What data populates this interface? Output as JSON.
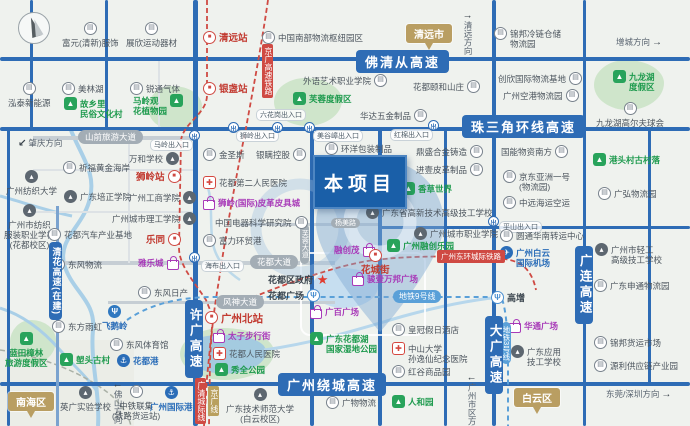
{
  "project": {
    "label": "本项目"
  },
  "colors": {
    "highway_blue": "#2e6cb5",
    "rail_red": "#cf4a43",
    "metro_blue": "#5aa0d8",
    "green_poi": "#1d9a4d",
    "purple_poi": "#a83ab8",
    "blue_poi": "#2a6db8",
    "station_red": "#c23a30",
    "city_tan": "#b99e62",
    "project_blue": "#1a5fa8",
    "water": "#a9cfe7"
  },
  "icon_glyphs": {
    "factory": "▤",
    "school": "▴",
    "tree": "▲",
    "hosp": "✚",
    "star": "★",
    "rail": "■",
    "metro": "Ψ",
    "metro2": "Ψ",
    "anchor": "⚓",
    "plane": "✈",
    "bag": "",
    "exit": "出"
  },
  "map": {
    "pois": [
      {
        "x": 62,
        "y": 22,
        "ic": "factory",
        "side": "t",
        "t": "富元(清新)服饰"
      },
      {
        "x": 126,
        "y": 22,
        "ic": "factory",
        "side": "t",
        "t": "展欣运动器材"
      },
      {
        "x": 203,
        "y": 31,
        "ic": "rail",
        "t": "清远站",
        "c": "red"
      },
      {
        "x": 262,
        "y": 31,
        "ic": "factory",
        "t": "中国南部物流枢纽园区"
      },
      {
        "x": 494,
        "y": 27,
        "ic": "factory",
        "t": "锦邦冷链仓储\n物流园"
      },
      {
        "x": 8,
        "y": 82,
        "ic": "factory",
        "side": "t",
        "t": "泓泰新能源"
      },
      {
        "x": 62,
        "y": 82,
        "ic": "factory",
        "t": "美林湖"
      },
      {
        "x": 130,
        "y": 82,
        "ic": "factory",
        "t": "锐通气体"
      },
      {
        "x": 64,
        "y": 97,
        "ic": "tree",
        "t": "故乡里\n民俗文化村",
        "c": "green"
      },
      {
        "x": 133,
        "y": 94,
        "ic": "tree",
        "side": "r",
        "t": "马岭观\n花植物园",
        "c": "green"
      },
      {
        "x": 203,
        "y": 82,
        "ic": "rail",
        "t": "银盏站",
        "c": "red"
      },
      {
        "x": 303,
        "y": 74,
        "ic": "factory",
        "side": "r",
        "t": "外语艺术职业学院"
      },
      {
        "x": 293,
        "y": 92,
        "ic": "tree",
        "t": "芙蓉度假区",
        "c": "green"
      },
      {
        "x": 413,
        "y": 80,
        "ic": "factory",
        "side": "r",
        "t": "花都颐和山庄"
      },
      {
        "x": 498,
        "y": 72,
        "ic": "factory",
        "side": "r",
        "t": "创欣国际物流基地"
      },
      {
        "x": 503,
        "y": 89,
        "ic": "factory",
        "side": "r",
        "t": "广州空港物流园"
      },
      {
        "x": 613,
        "y": 70,
        "ic": "tree",
        "t": "九龙湖\n度假区",
        "c": "green"
      },
      {
        "x": 596,
        "y": 102,
        "ic": "factory",
        "side": "t",
        "t": "九龙湖高尔夫球会"
      },
      {
        "x": 360,
        "y": 109,
        "ic": "factory",
        "side": "r",
        "t": "华达五金制品"
      },
      {
        "x": 6,
        "y": 170,
        "ic": "school",
        "side": "t",
        "t": "广州纺织大学"
      },
      {
        "x": 4,
        "y": 204,
        "ic": "school",
        "side": "t",
        "t": "广州市纺织\n服装职业学校\n(花都校区)"
      },
      {
        "x": 63,
        "y": 161,
        "ic": "factory",
        "t": "祈福黄金海岸"
      },
      {
        "x": 129,
        "y": 152,
        "ic": "school",
        "side": "r",
        "t": "万和学校"
      },
      {
        "x": 136,
        "y": 170,
        "ic": "rail",
        "side": "r",
        "t": "狮岭站",
        "c": "red"
      },
      {
        "x": 64,
        "y": 190,
        "ic": "school",
        "t": "广东培正学院"
      },
      {
        "x": 129,
        "y": 191,
        "ic": "school",
        "side": "r",
        "t": "广州工商学院"
      },
      {
        "x": 112,
        "y": 212,
        "ic": "school",
        "side": "r",
        "t": "广州城市理工学院"
      },
      {
        "x": 48,
        "y": 228,
        "ic": "factory",
        "t": "花都汽车产业基地"
      },
      {
        "x": 146,
        "y": 233,
        "ic": "rail",
        "side": "r",
        "t": "乐同",
        "c": "red"
      },
      {
        "x": 52,
        "y": 258,
        "ic": "factory",
        "t": "东风物流"
      },
      {
        "x": 138,
        "y": 256,
        "ic": "bag",
        "side": "r",
        "t": "雅乐城",
        "c": "purple"
      },
      {
        "x": 203,
        "y": 148,
        "ic": "factory",
        "t": "金圣斯"
      },
      {
        "x": 256,
        "y": 148,
        "ic": "factory",
        "side": "r",
        "t": "银瞒控股"
      },
      {
        "x": 203,
        "y": 176,
        "ic": "hosp",
        "t": "花都第二人民医院"
      },
      {
        "x": 203,
        "y": 196,
        "ic": "bag",
        "t": "狮岭(国际)皮革皮具城",
        "c": "purple"
      },
      {
        "x": 215,
        "y": 216,
        "ic": "factory",
        "side": "r",
        "t": "中国电器科学研究院"
      },
      {
        "x": 203,
        "y": 234,
        "ic": "factory",
        "t": "富力环贸港"
      },
      {
        "x": 325,
        "y": 142,
        "ic": "factory",
        "t": "环洋包装制品"
      },
      {
        "x": 416,
        "y": 145,
        "ic": "factory",
        "side": "r",
        "t": "鼎盛合金铸造"
      },
      {
        "x": 416,
        "y": 163,
        "ic": "factory",
        "side": "r",
        "t": "进壹皮革制品"
      },
      {
        "x": 402,
        "y": 182,
        "ic": "tree",
        "t": "香草世界",
        "c": "green"
      },
      {
        "x": 366,
        "y": 206,
        "ic": "school",
        "t": "广东省高新技术高级技工学校"
      },
      {
        "x": 414,
        "y": 227,
        "ic": "school",
        "t": "广州城市职业学院"
      },
      {
        "x": 387,
        "y": 239,
        "ic": "tree",
        "t": "广州融创乐园",
        "c": "green"
      },
      {
        "x": 334,
        "y": 243,
        "ic": "bag",
        "side": "r",
        "t": "融创茂",
        "c": "purple"
      },
      {
        "x": 361,
        "y": 249,
        "ic": "rail",
        "side": "t",
        "t": "花城街",
        "c": "red"
      },
      {
        "x": 500,
        "y": 229,
        "ic": "factory",
        "t": "圆通华南转运中心"
      },
      {
        "x": 500,
        "y": 246,
        "ic": "plane",
        "t": "广州白云\n国际机场",
        "c": "blue"
      },
      {
        "x": 593,
        "y": 153,
        "ic": "tree",
        "t": "港头村古村落",
        "c": "green"
      },
      {
        "x": 598,
        "y": 187,
        "ic": "factory",
        "t": "广弘物流园"
      },
      {
        "x": 501,
        "y": 145,
        "ic": "factory",
        "side": "r",
        "t": "国能物资南方"
      },
      {
        "x": 503,
        "y": 170,
        "ic": "factory",
        "t": "京东亚洲一号\n(物流园)"
      },
      {
        "x": 503,
        "y": 196,
        "ic": "factory",
        "t": "中远海运空运"
      },
      {
        "x": 595,
        "y": 243,
        "ic": "school",
        "t": "广州市轻工\n高级技工学校"
      },
      {
        "x": 138,
        "y": 286,
        "ic": "factory",
        "t": "东风日产"
      },
      {
        "x": 52,
        "y": 320,
        "ic": "factory",
        "t": "东方雨虹"
      },
      {
        "x": 102,
        "y": 305,
        "ic": "metro2",
        "side": "t",
        "t": "飞鹅岭",
        "c": "blue"
      },
      {
        "x": 110,
        "y": 338,
        "ic": "factory",
        "t": "东风体育馆"
      },
      {
        "x": 117,
        "y": 354,
        "ic": "anchor",
        "t": "花都港",
        "c": "blue"
      },
      {
        "x": 268,
        "y": 273,
        "ic": "star",
        "side": "r",
        "t": "花都区政府",
        "c": "dark"
      },
      {
        "x": 352,
        "y": 272,
        "ic": "bag",
        "t": "骏壹万邦广场",
        "c": "purple"
      },
      {
        "x": 268,
        "y": 289,
        "ic": "metro",
        "side": "r",
        "t": "花都广场",
        "c": "dark"
      },
      {
        "x": 310,
        "y": 305,
        "ic": "bag",
        "t": "广百广场",
        "c": "purple"
      },
      {
        "x": 310,
        "y": 332,
        "ic": "tree",
        "t": "广东花都湖\n国家湿地公园",
        "c": "green"
      },
      {
        "x": 392,
        "y": 323,
        "ic": "factory",
        "t": "皇冠假日酒店"
      },
      {
        "x": 392,
        "y": 342,
        "ic": "hosp",
        "t": "中山大学\n孙逸仙纪念医院"
      },
      {
        "x": 392,
        "y": 365,
        "ic": "factory",
        "t": "红谷商品园"
      },
      {
        "x": 226,
        "y": 388,
        "ic": "school",
        "side": "t",
        "t": "广东技术师范大学\n(白云校区)"
      },
      {
        "x": 326,
        "y": 396,
        "ic": "factory",
        "t": "广物物流"
      },
      {
        "x": 392,
        "y": 395,
        "ic": "tree",
        "t": "人和园",
        "c": "green"
      },
      {
        "x": 205,
        "y": 311,
        "ic": "rail",
        "t": "广州北站",
        "c": "redbig"
      },
      {
        "x": 213,
        "y": 329,
        "ic": "bag",
        "t": "太子步行街",
        "c": "purple"
      },
      {
        "x": 213,
        "y": 347,
        "ic": "hosp",
        "t": "花都人民医院"
      },
      {
        "x": 215,
        "y": 363,
        "ic": "tree",
        "t": "秀全公园",
        "c": "green"
      },
      {
        "x": 5,
        "y": 332,
        "ic": "tree",
        "side": "t",
        "t": "蓝田樟林\n旅游度假区",
        "c": "green"
      },
      {
        "x": 60,
        "y": 353,
        "ic": "tree",
        "t": "塱头古村",
        "c": "green"
      },
      {
        "x": 60,
        "y": 386,
        "ic": "school",
        "side": "t",
        "t": "英广实验学校"
      },
      {
        "x": 112,
        "y": 385,
        "ic": "factory",
        "side": "t",
        "t": "中铁联集\n(铁路货运站)"
      },
      {
        "x": 150,
        "y": 386,
        "ic": "anchor",
        "side": "t",
        "t": "广州国际港",
        "c": "blue"
      },
      {
        "x": 491,
        "y": 291,
        "ic": "metro",
        "t": "高增",
        "c": "dark"
      },
      {
        "x": 509,
        "y": 319,
        "ic": "bag",
        "t": "华通广场",
        "c": "purple"
      },
      {
        "x": 511,
        "y": 345,
        "ic": "school",
        "t": "广东应用\n技工学校"
      },
      {
        "x": 594,
        "y": 279,
        "ic": "factory",
        "t": "广东申通物流园"
      },
      {
        "x": 594,
        "y": 336,
        "ic": "factory",
        "t": "锦邦货运市场"
      },
      {
        "x": 594,
        "y": 359,
        "ic": "factory",
        "t": "源利供应链产业园"
      }
    ],
    "line_labels": [
      {
        "x": 356,
        "y": 50,
        "t": "佛清从高速",
        "cls": "hwy hwy-big"
      },
      {
        "x": 462,
        "y": 115,
        "t": "珠三角环线高速",
        "cls": "hwy hwy-big"
      },
      {
        "x": 278,
        "y": 373,
        "t": "广州绕城高速",
        "cls": "hwy hwy-big"
      },
      {
        "x": 185,
        "y": 300,
        "t": "许广高速",
        "cls": "hwy hwy-v"
      },
      {
        "x": 485,
        "y": 316,
        "t": "大广高速",
        "cls": "hwy hwy-v"
      },
      {
        "x": 575,
        "y": 246,
        "t": "广连高速",
        "cls": "hwy hwy-v"
      },
      {
        "x": 49,
        "y": 242,
        "t": "清花高速(在建)",
        "cls": "hwy hwy-v small"
      },
      {
        "x": 262,
        "y": 44,
        "t": "京广高速铁路",
        "cls": "rail-v"
      },
      {
        "x": 195,
        "y": 378,
        "t": "广清城际线",
        "cls": "rail-v"
      },
      {
        "x": 208,
        "y": 386,
        "t": "京广线",
        "cls": "jgx-v"
      },
      {
        "x": 437,
        "y": 250,
        "t": "广州东环城际铁路",
        "cls": "rail-h"
      },
      {
        "x": 393,
        "y": 290,
        "t": "地铁9号线",
        "cls": "metro-h"
      },
      {
        "x": 501,
        "y": 322,
        "t": "地铁3号线",
        "cls": "metro-v"
      },
      {
        "x": 78,
        "y": 130,
        "t": "山前旅游大道",
        "cls": "road-lbl"
      },
      {
        "x": 250,
        "y": 255,
        "t": "花都大道",
        "cls": "road-lbl"
      },
      {
        "x": 216,
        "y": 295,
        "t": "风神大道",
        "cls": "road-lbl"
      },
      {
        "x": 331,
        "y": 218,
        "t": "杨美路",
        "cls": "road-lbl sm"
      },
      {
        "x": 300,
        "y": 224,
        "t": "芙蓉大道",
        "cls": "road-lbl sm v"
      }
    ],
    "exits": [
      {
        "x": 189,
        "y": 130,
        "t": "马岭出入口",
        "lx": 150,
        "ly": 139
      },
      {
        "x": 228,
        "y": 122,
        "t": "狮岭出入口",
        "lx": 236,
        "ly": 130
      },
      {
        "x": 272,
        "y": 122,
        "t": "六花岗出入口",
        "lx": 256,
        "ly": 109
      },
      {
        "x": 304,
        "y": 122,
        "t": "美谷嶂出入口",
        "lx": 313,
        "ly": 130
      },
      {
        "x": 428,
        "y": 120,
        "t": "红棉出入口",
        "lx": 390,
        "ly": 129
      },
      {
        "x": 189,
        "y": 252,
        "t": "海布出入口",
        "lx": 201,
        "ly": 260
      },
      {
        "x": 488,
        "y": 216,
        "t": "平山出入口",
        "lx": 499,
        "ly": 221
      }
    ],
    "cities": [
      {
        "x": 406,
        "y": 24,
        "t": "清远市"
      },
      {
        "x": 8,
        "y": 392,
        "t": "南海区"
      },
      {
        "x": 514,
        "y": 388,
        "t": "白云区"
      }
    ],
    "directions": [
      {
        "x": 462,
        "y": 14,
        "t": "清远方向",
        "d": "v",
        "a": "↑",
        "ap": "pre"
      },
      {
        "x": 616,
        "y": 36,
        "t": "增城方向",
        "d": "h",
        "a": "→",
        "ap": "post"
      },
      {
        "x": 18,
        "y": 137,
        "t": "肇庆方向",
        "d": "h",
        "a": "↙",
        "ap": "pre"
      },
      {
        "x": 112,
        "y": 383,
        "t": "佛山方向",
        "d": "v",
        "a": "↓",
        "ap": "pre"
      },
      {
        "x": 466,
        "y": 376,
        "t": "广州市区方向",
        "d": "v",
        "a": "↓",
        "ap": "pre"
      },
      {
        "x": 606,
        "y": 388,
        "t": "东莞/深圳方向",
        "d": "h",
        "a": "→",
        "ap": "post"
      }
    ]
  }
}
